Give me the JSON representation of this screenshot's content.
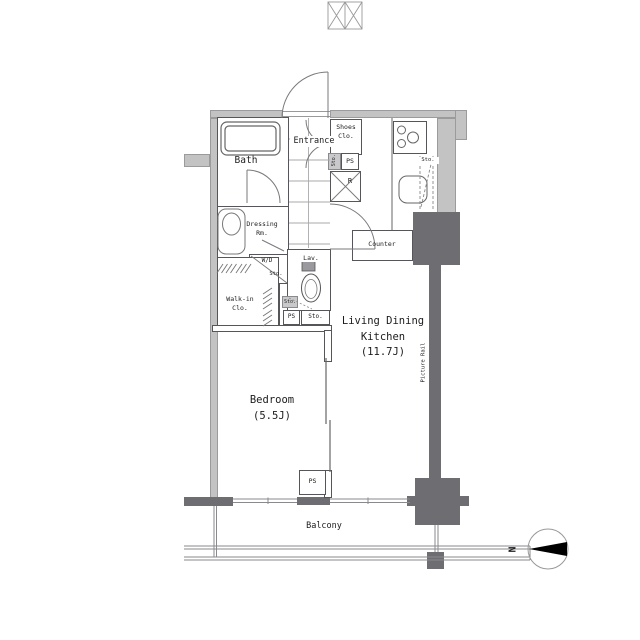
{
  "title": "apartment-floor-plan",
  "colors": {
    "background": "#ffffff",
    "wall_fill": "#c3c3c4",
    "column_fill": "#6e6e72",
    "line": "#555555",
    "tile_grid": "#aaaaaa",
    "text": "#1c1c1c",
    "compass_arrow": "#000000"
  },
  "labels": {
    "bath": "Bath",
    "entrance": "Entrance",
    "shoes_closet": "Shoes\nClo.",
    "shoes_storage": "Sto.",
    "entry_pipe_space": "PS",
    "refrigerator": "R",
    "kitchen_storage": "Sto.",
    "counter": "Counter",
    "dressing_room": "Dressing\nRm.",
    "washer_dryer": "W/D",
    "washer_dryer_storage": "Sto.",
    "lavatory": "Lav.",
    "lavatory_storage": "Sto.",
    "walk_in_closet": "Walk-in\nClo.",
    "pipe_space_mid": "PS",
    "storage_mid": "Sto.",
    "living_dining_kitchen": "Living Dining\nKitchen\n(11.7J)",
    "bedroom": "Bedroom\n(5.5J)",
    "picture_rail": "Picture Rail",
    "pipe_space_balcony": "PS",
    "balcony": "Balcony",
    "north": "N"
  }
}
